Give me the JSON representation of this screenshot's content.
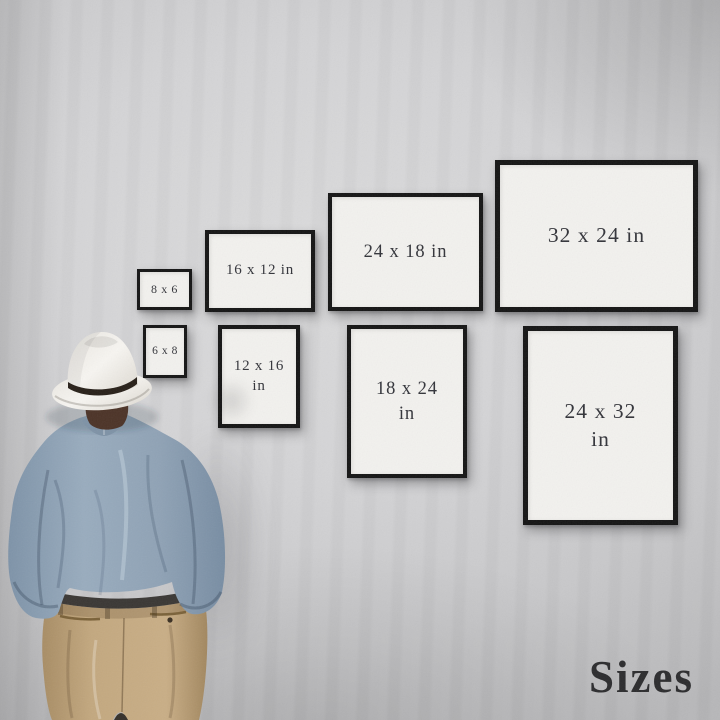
{
  "caption": "Sizes",
  "frames": [
    {
      "id": "8x6",
      "lines": [
        "8 x 6"
      ],
      "orientation": "landscape"
    },
    {
      "id": "16x12",
      "lines": [
        "16 x 12 in"
      ],
      "orientation": "landscape"
    },
    {
      "id": "24x18",
      "lines": [
        "24 x 18 in"
      ],
      "orientation": "landscape"
    },
    {
      "id": "32x24",
      "lines": [
        "32 x 24 in"
      ],
      "orientation": "landscape"
    },
    {
      "id": "6x8",
      "lines": [
        "6 x 8"
      ],
      "orientation": "portrait"
    },
    {
      "id": "12x16",
      "lines": [
        "12 x 16",
        "in"
      ],
      "orientation": "portrait"
    },
    {
      "id": "18x24",
      "lines": [
        "18 x 24",
        "in"
      ],
      "orientation": "portrait"
    },
    {
      "id": "24x32",
      "lines": [
        "24 x 32",
        "in"
      ],
      "orientation": "portrait"
    }
  ],
  "colors": {
    "wall": "#d2d2d4",
    "frame_border": "#151515",
    "frame_mat": "#f2f1ee",
    "label_text": "#33343a",
    "caption_text": "#2c2c2e",
    "hat": "#f4f2ee",
    "hat_band": "#29211a",
    "shirt": "#92a5b8",
    "trousers": "#c2a77f",
    "hair": "#4c3327"
  }
}
